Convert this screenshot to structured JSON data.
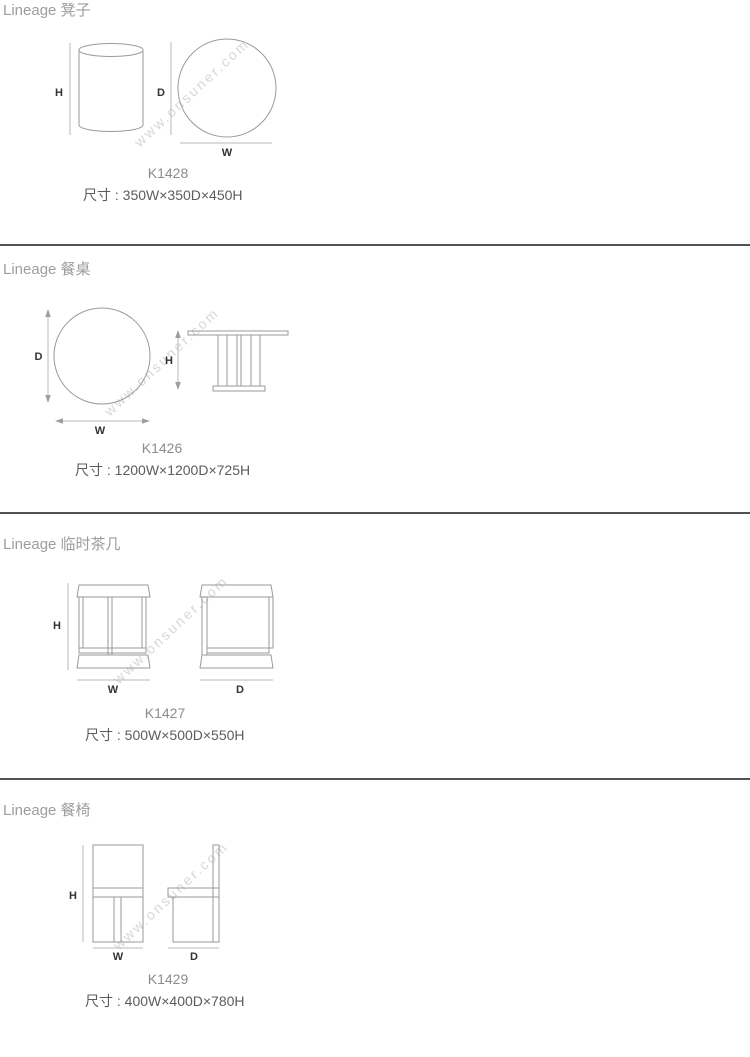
{
  "watermark": "www.onsuner.com",
  "sections": [
    {
      "title": "Lineage 凳子",
      "model": "K1428",
      "size": "尺寸 : 350W×350D×450H",
      "labels": {
        "h": "H",
        "d": "D",
        "w": "W"
      }
    },
    {
      "title": "Lineage 餐桌",
      "model": "K1426",
      "size": "尺寸 : 1200W×1200D×725H",
      "labels": {
        "h": "H",
        "d": "D",
        "w": "W"
      }
    },
    {
      "title": "Lineage 临时茶几",
      "model": "K1427",
      "size": "尺寸 : 500W×500D×550H",
      "labels": {
        "h": "H",
        "d": "D",
        "w": "W"
      }
    },
    {
      "title": "Lineage 餐椅",
      "model": "K1429",
      "size": "尺寸 : 400W×400D×780H",
      "labels": {
        "h": "H",
        "d": "D",
        "w": "W"
      }
    }
  ]
}
